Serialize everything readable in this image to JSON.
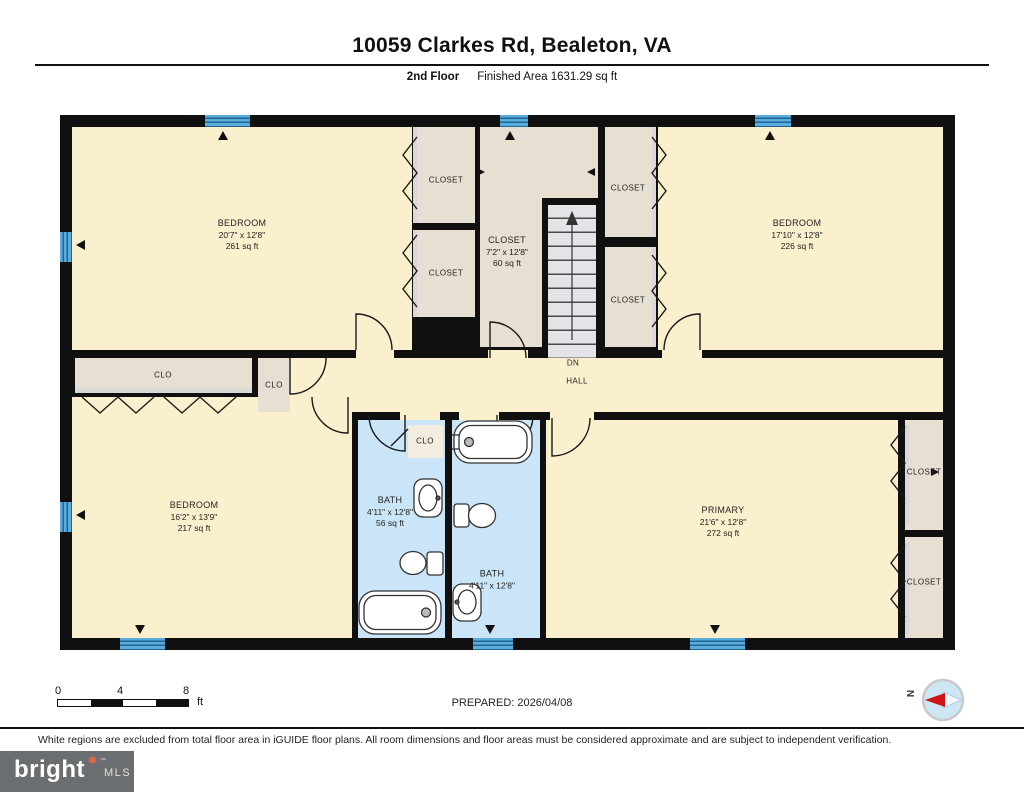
{
  "header": {
    "title": "10059 Clarkes Rd, Bealeton, VA",
    "floor_label": "2nd Floor",
    "area_label": "Finished Area 1631.29 sq ft"
  },
  "labels": {
    "closet": "CLOSET",
    "clo": "CLO",
    "dn": "DN",
    "hall": "HALL"
  },
  "rooms": {
    "bedroom_tl": {
      "name": "BEDROOM",
      "dims": "20'7\" x 12'8\"",
      "area": "261 sq ft"
    },
    "bedroom_tr": {
      "name": "BEDROOM",
      "dims": "17'10\" x 12'8\"",
      "area": "226 sq ft"
    },
    "closet_mid": {
      "name": "CLOSET",
      "dims": "7'2\" x 12'8\"",
      "area": "60 sq ft"
    },
    "bedroom_bl": {
      "name": "BEDROOM",
      "dims": "16'2\" x 13'9\"",
      "area": "217 sq ft"
    },
    "bath_left": {
      "name": "BATH",
      "dims": "4'11\" x 12'8\"",
      "area": "56 sq ft"
    },
    "bath_right": {
      "name": "BATH",
      "dims": "4'11\" x 12'8\""
    },
    "primary": {
      "name": "PRIMARY",
      "dims": "21'6\" x 12'8\"",
      "area": "272 sq ft"
    }
  },
  "footer": {
    "scale_ticks": [
      "0",
      "4",
      "8"
    ],
    "scale_unit": "ft",
    "prepared": "PREPARED: 2026/04/08",
    "compass_label": "N"
  },
  "disclaimer": "White regions are excluded from total floor area in iGUIDE floor plans. All room dimensions and floor areas must be considered approximate and are subject to independent verification.",
  "logo": {
    "brand": "bright",
    "star": "✱",
    "tm": "™",
    "suffix": "MLS"
  },
  "colors": {
    "room_cream": "#FBF0CD",
    "closet_tan": "#E7DFD2",
    "bath_blue": "#C9E5F7",
    "window_blue": "#5BACDA",
    "wall": "#101010",
    "compass_red": "#D01317",
    "logo_orange": "#E8683A",
    "logo_gray": "#6B6E71"
  }
}
